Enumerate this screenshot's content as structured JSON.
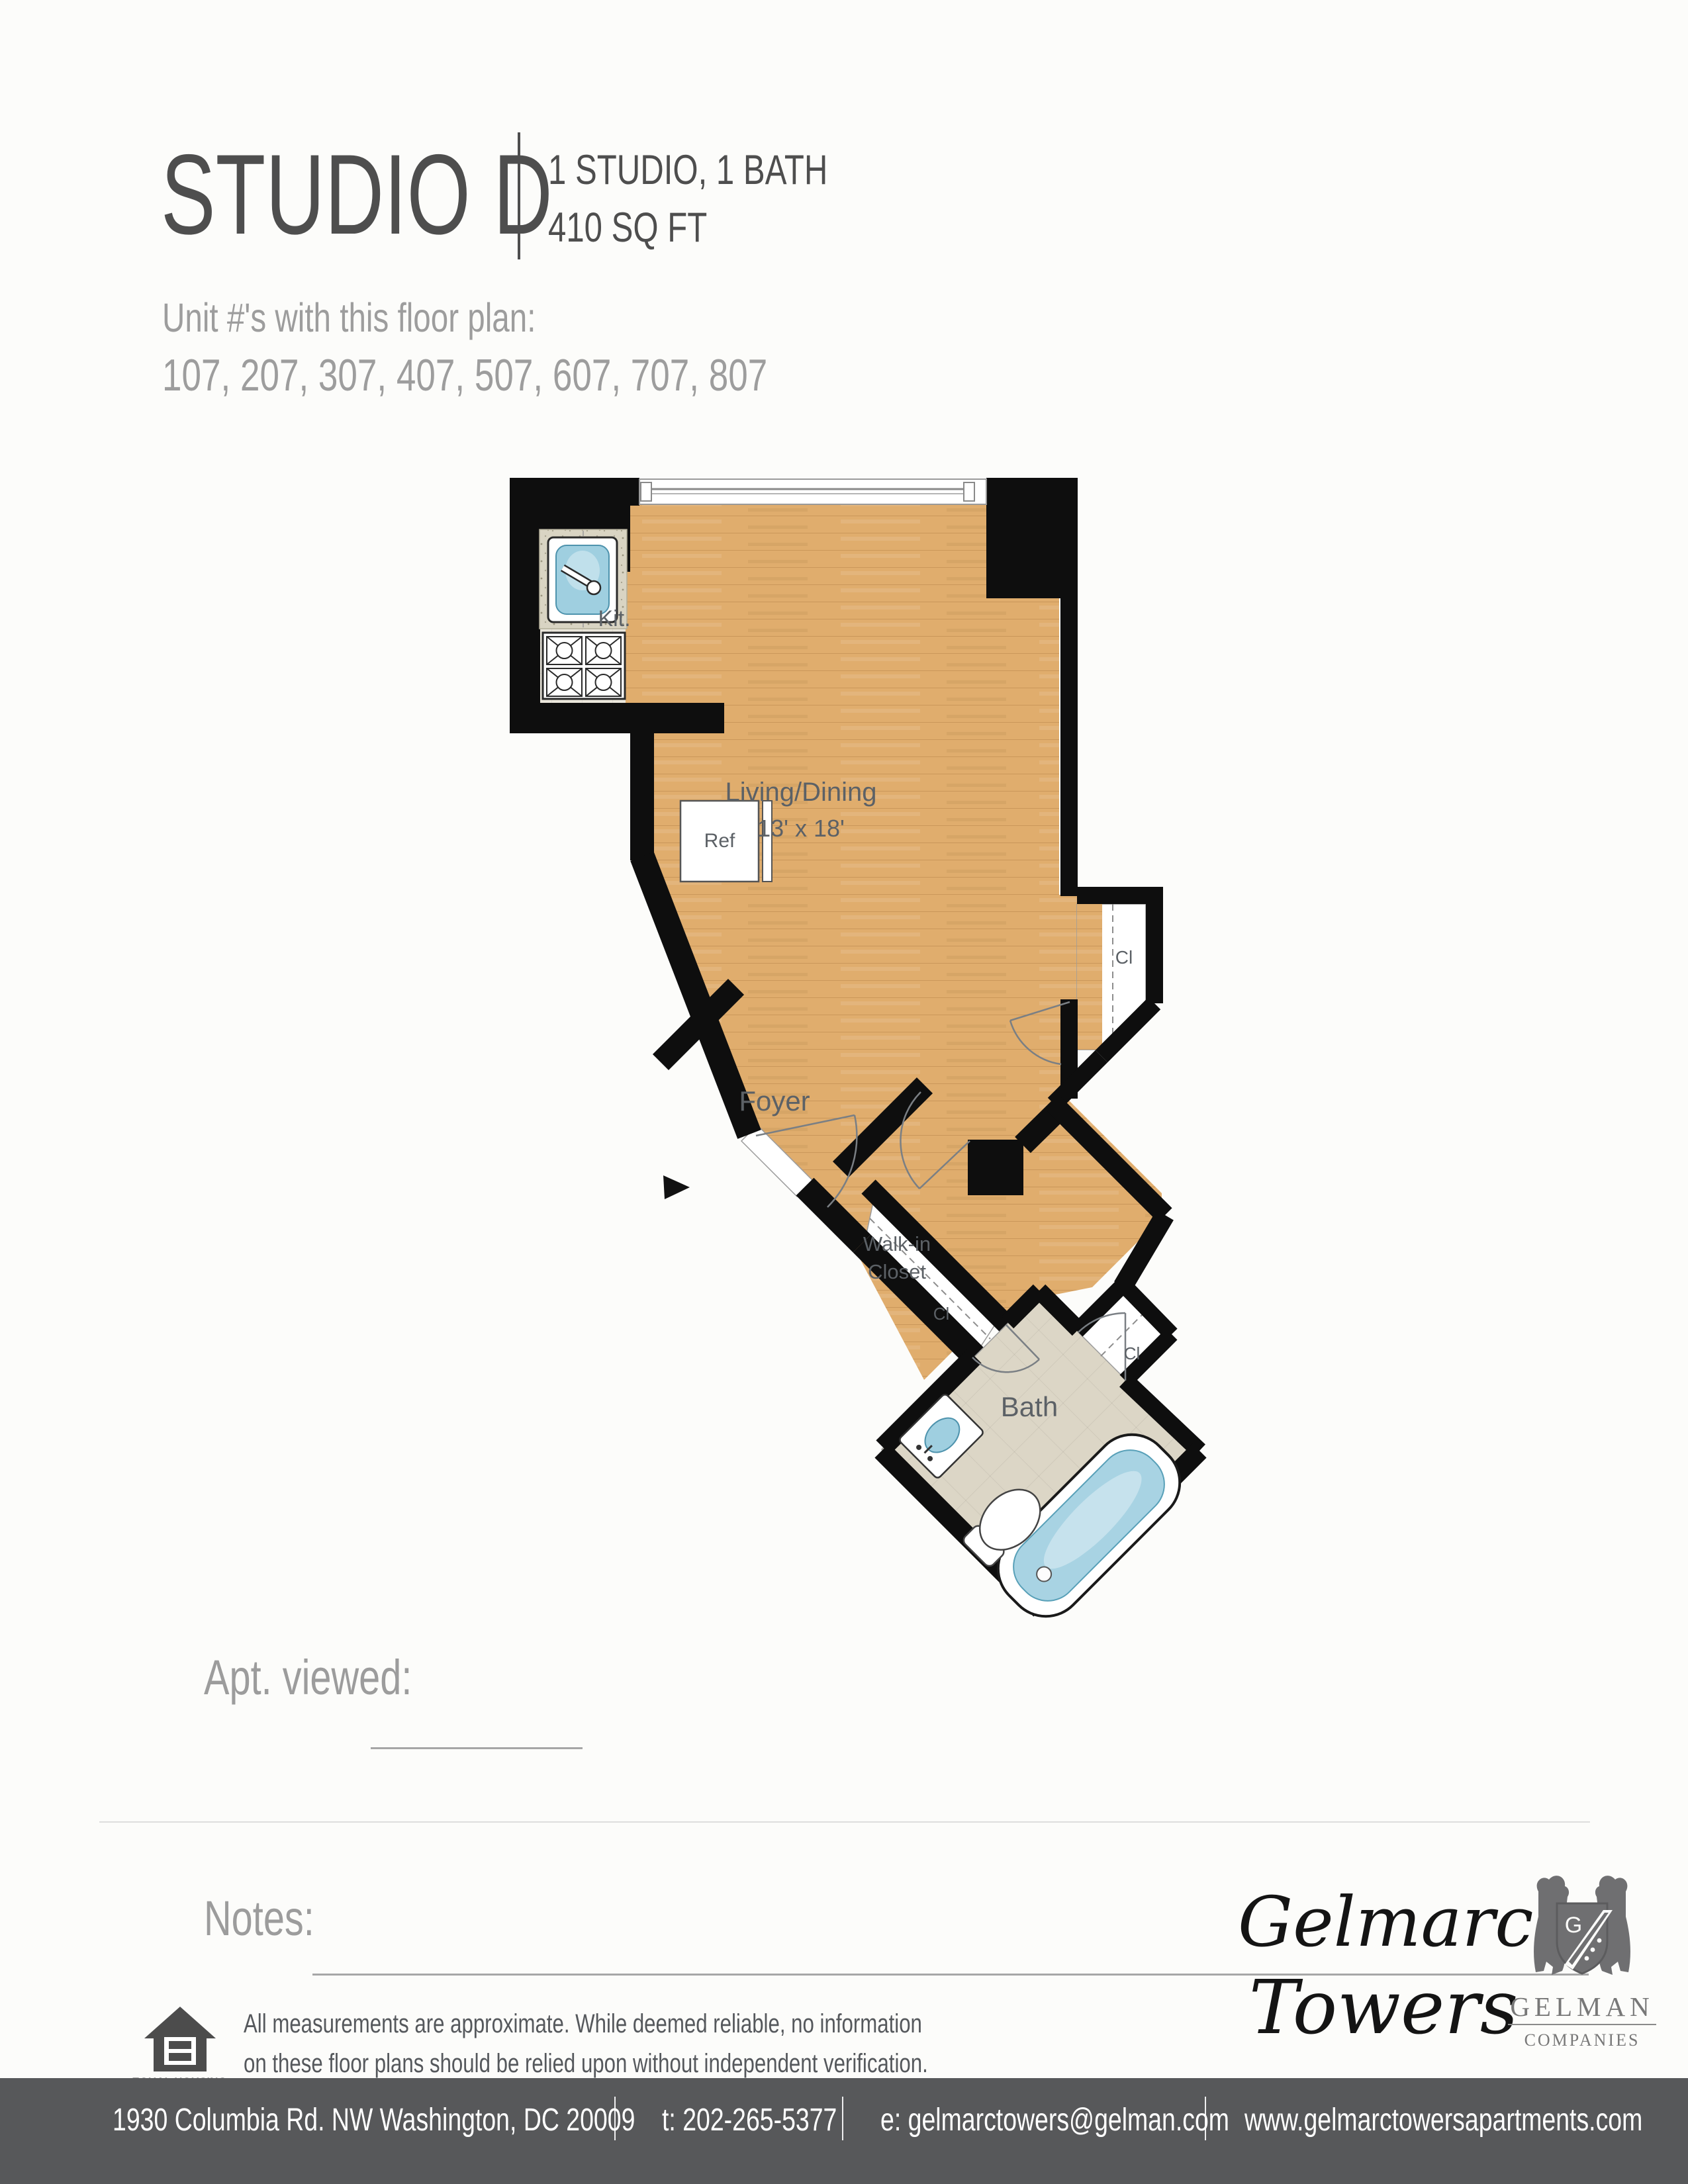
{
  "header": {
    "title": "STUDIO D",
    "spec_line1": "1 STUDIO, 1 BATH",
    "spec_line2": "410 SQ FT",
    "units_label": "Unit #'s with this floor plan:",
    "units": "107, 207, 307, 407, 507, 607, 707, 807"
  },
  "plan": {
    "labels": {
      "kitchen": "Kit.",
      "ref": "Ref",
      "living": "Living/Dining",
      "living_dims": "13' x 18'",
      "foyer": "Foyer",
      "walkin_line1": "Walk-in",
      "walkin_line2": "Closet",
      "closet_right": "Cl",
      "closet_corridor": "Cl",
      "closet_bath": "Cl",
      "bath": "Bath"
    },
    "colors": {
      "wall": "#0e0e0e",
      "wood": "#e0ad6d",
      "kitchen_tile": "#eae6db",
      "bath_tile": "#dcd6c6",
      "counter": "#d9d4c3",
      "water": "#9fcfe0",
      "label": "#5c6166"
    }
  },
  "viewing": {
    "apt_viewed_label": "Apt. viewed:",
    "notes_label": "Notes:"
  },
  "disclaimer": {
    "line1": "All measurements are approximate. While deemed reliable, no information",
    "line2": "on these floor plans should be relied upon without independent verification.",
    "eho_line1": "EQUAL HOUSING",
    "eho_line2": "OPPORTUNITY"
  },
  "branding": {
    "property_line1": "Gelmarc",
    "property_line2": "Towers",
    "company_monogram": "G",
    "company_name": "GELMAN",
    "company_suffix": "COMPANIES"
  },
  "footer": {
    "address": "1930 Columbia Rd. NW  Washington, DC 20009",
    "phone": "t: 202-265-5377",
    "email": "e: gelmarctowers@gelman.com",
    "website": "www.gelmarctowersapartments.com"
  }
}
